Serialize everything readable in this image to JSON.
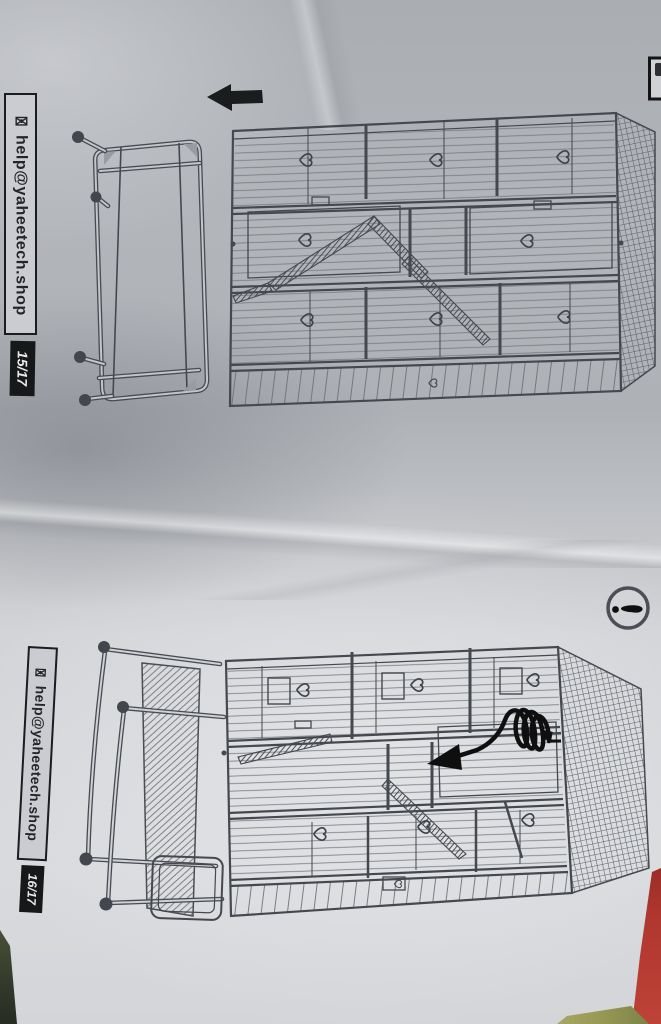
{
  "sheets": [
    {
      "contact_email": "help@yaheetech.shop",
      "page_indicator": "15/17"
    },
    {
      "contact_email": "help@yaheetech.shop",
      "page_indicator": "16/17"
    }
  ],
  "icons": {
    "envelope_glyph": "✉",
    "direction_arrow": "left",
    "notice_icon": "exclamation-circle"
  },
  "figures": [
    "caster-stand-frame",
    "three-tier-cage",
    "cage-mounted-on-stand",
    "coil-spring-arrow"
  ],
  "colors": {
    "paper_light": "#d8dadd",
    "paper_dark": "#a9acb1",
    "line_ink": "#45484e",
    "solid_black": "#17181a",
    "edge_red": "#b0372f",
    "edge_green": "#343b2c",
    "edge_yellow": "#939651"
  }
}
